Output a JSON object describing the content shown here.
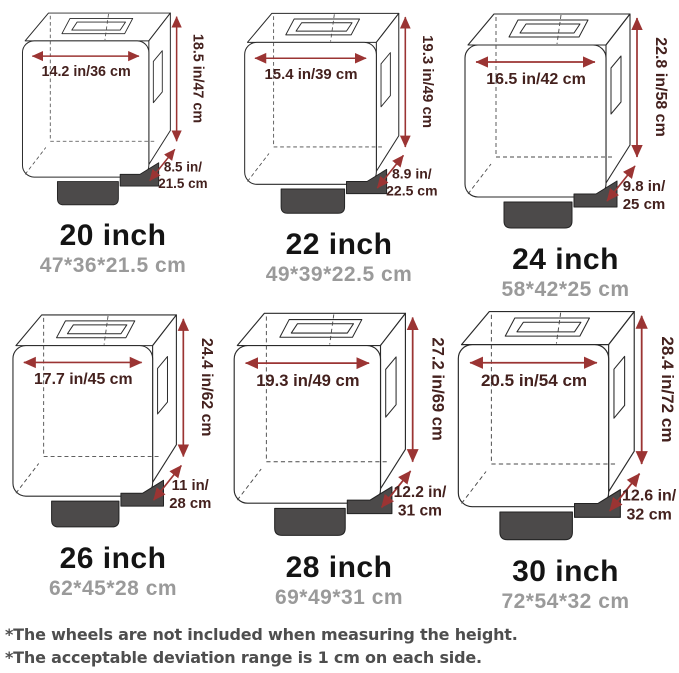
{
  "items": [
    {
      "size_label": "20 inch",
      "cm_label": "47*36*21.5 cm",
      "width_label": "14.2 in/36 cm",
      "height_label": "18.5 in/47 cm",
      "depth_line1": "8.5 in/",
      "depth_line2": "21.5 cm"
    },
    {
      "size_label": "22 inch",
      "cm_label": "49*39*22.5 cm",
      "width_label": "15.4 in/39 cm",
      "height_label": "19.3 in/49 cm",
      "depth_line1": "8.9 in/",
      "depth_line2": "22.5 cm"
    },
    {
      "size_label": "24 inch",
      "cm_label": "58*42*25 cm",
      "width_label": "16.5 in/42 cm",
      "height_label": "22.8 in/58 cm",
      "depth_line1": "9.8 in/",
      "depth_line2": "25 cm"
    },
    {
      "size_label": "26 inch",
      "cm_label": "62*45*28 cm",
      "width_label": "17.7 in/45 cm",
      "height_label": "24.4 in/62 cm",
      "depth_line1": "11 in/",
      "depth_line2": "28 cm"
    },
    {
      "size_label": "28 inch",
      "cm_label": "69*49*31 cm",
      "width_label": "19.3 in/49 cm",
      "height_label": "27.2 in/69 cm",
      "depth_line1": "12.2 in/",
      "depth_line2": "31 cm"
    },
    {
      "size_label": "30 inch",
      "cm_label": "72*54*32 cm",
      "width_label": "20.5 in/54 cm",
      "height_label": "28.4 in/72 cm",
      "depth_line1": "12.6 in/",
      "depth_line2": "32 cm"
    }
  ],
  "footnotes": [
    "*The wheels are not included when measuring the height.",
    "*The acceptable deviation range is 1 cm on each side."
  ],
  "colors": {
    "arrow": "#9b3433",
    "dimtext": "#44211e",
    "title": "#141414",
    "subtitle": "#9a9a9a",
    "basefill": "#4c4a4a",
    "outline": "#2a2a2a",
    "footnote": "#4e4e4e"
  }
}
